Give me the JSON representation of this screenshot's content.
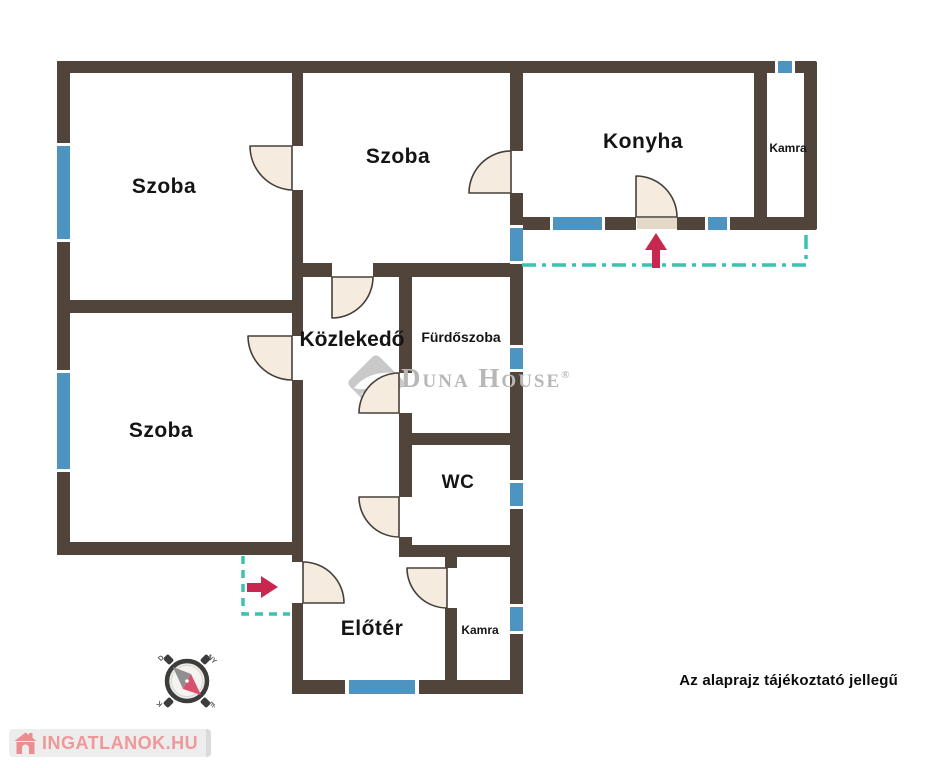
{
  "rooms": [
    {
      "id": "szoba-1",
      "label": "Szoba"
    },
    {
      "id": "szoba-2",
      "label": "Szoba"
    },
    {
      "id": "konyha",
      "label": "Konyha"
    },
    {
      "id": "kamra-upper",
      "label": "Kamra"
    },
    {
      "id": "szoba-3",
      "label": "Szoba"
    },
    {
      "id": "kozlekedo",
      "label": "Közlekedő"
    },
    {
      "id": "furdoszoba",
      "label": "Fürdőszoba"
    },
    {
      "id": "wc",
      "label": "WC"
    },
    {
      "id": "eloter",
      "label": "Előtér"
    },
    {
      "id": "kamra-lower",
      "label": "Kamra"
    }
  ],
  "watermark": {
    "brand": "Duna House",
    "registered": "®"
  },
  "footer": {
    "disclaimer": "Az alaprajz tájékoztató jellegű",
    "site_logo": "INGATLANOK.HU"
  },
  "compass": {
    "labels": {
      "top_left": "D",
      "top_right": "NY",
      "bottom_right": "É",
      "bottom_left": "K"
    }
  },
  "colors": {
    "wall": "#51453B",
    "window": "#4E94C1",
    "door-fill": "#F5ECDF",
    "door-stroke": "#45403A",
    "teal": "#3CC2B0",
    "arrow-red": "#C8284F",
    "watermark-gray": "#B7B7B7",
    "brand-pink": "#EF9899",
    "ink": "#141414"
  }
}
